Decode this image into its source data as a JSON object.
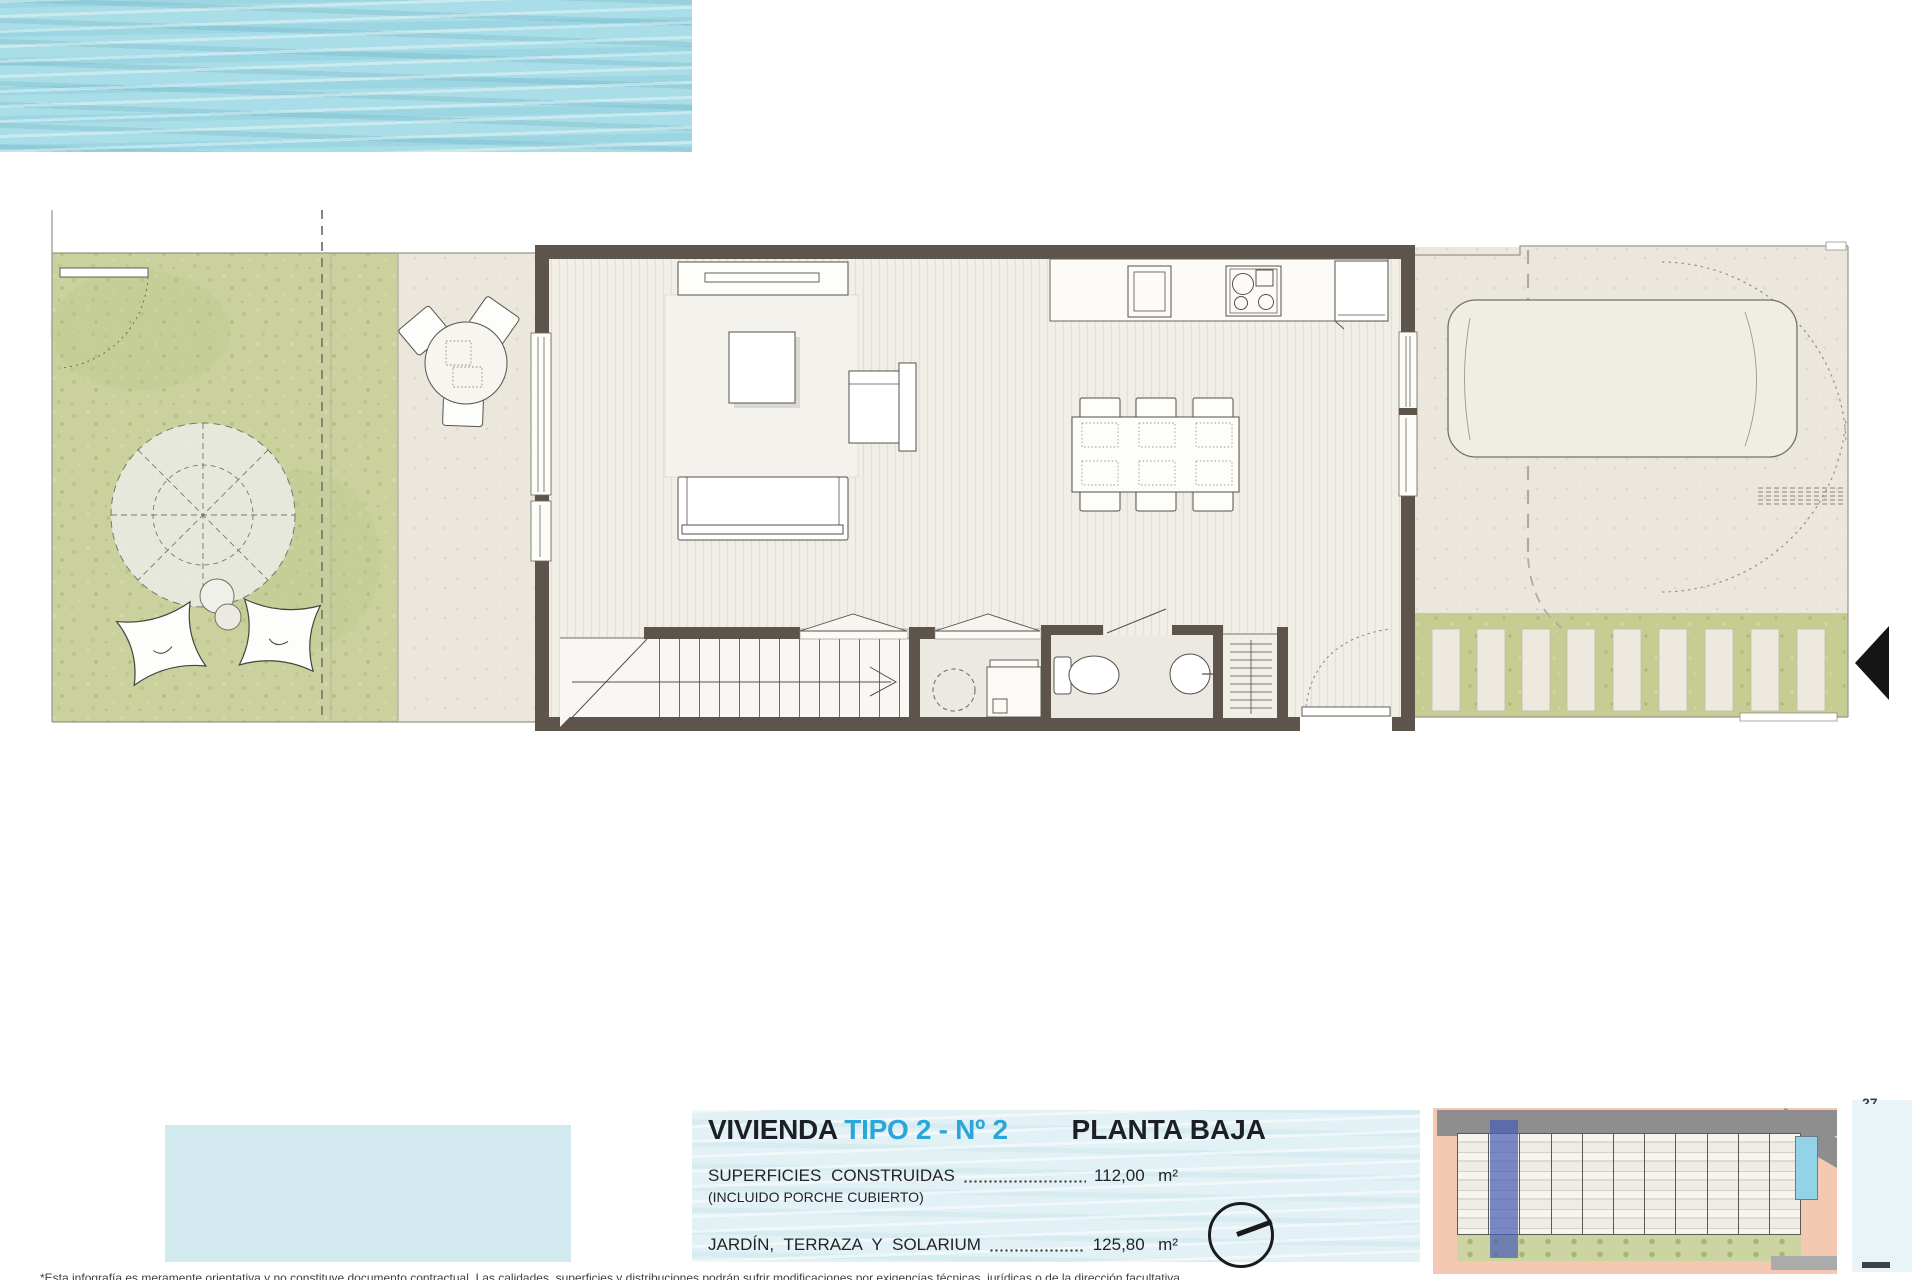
{
  "sheet": {
    "kind": "architectural floor plan sheet"
  },
  "info_panel": {
    "title_prefix": "VIVIENDA",
    "title_highlight": "TIPO 2 - Nº 2",
    "plan_label": "PLANTA BAJA",
    "areas": [
      {
        "label": "SUPERFICIES CONSTRUIDAS",
        "sublabel": "(INCLUIDO PORCHE CUBIERTO)",
        "value": "112,00",
        "unit": "m²"
      },
      {
        "label": "JARDÍN, TERRAZA Y SOLARIUM",
        "sublabel": "",
        "value": "125,80",
        "unit": "m²"
      }
    ]
  },
  "page": {
    "number": "27",
    "disclaimer": "*Esta infografía es meramente orientativa y no constituye documento contractual. Las calidades, superficies y distribuciones podrán sufrir modificaciones por exigencias técnicas, jurídicas o de la dirección facultativa."
  },
  "icons": {
    "north": "north-indicator-icon",
    "entry_arrow": "entry-arrow-icon"
  },
  "colors": {
    "accent_blue": "#2BA6D9",
    "title_dark": "#1D1F27",
    "wall": "#5D554B",
    "garden_green": "#C9D09C",
    "paving_beige": "#EBE7DC",
    "water": "#A9DDE7",
    "sitemap_highlight": "#495FB6",
    "sitemap_bg": "#F4C9B1"
  }
}
